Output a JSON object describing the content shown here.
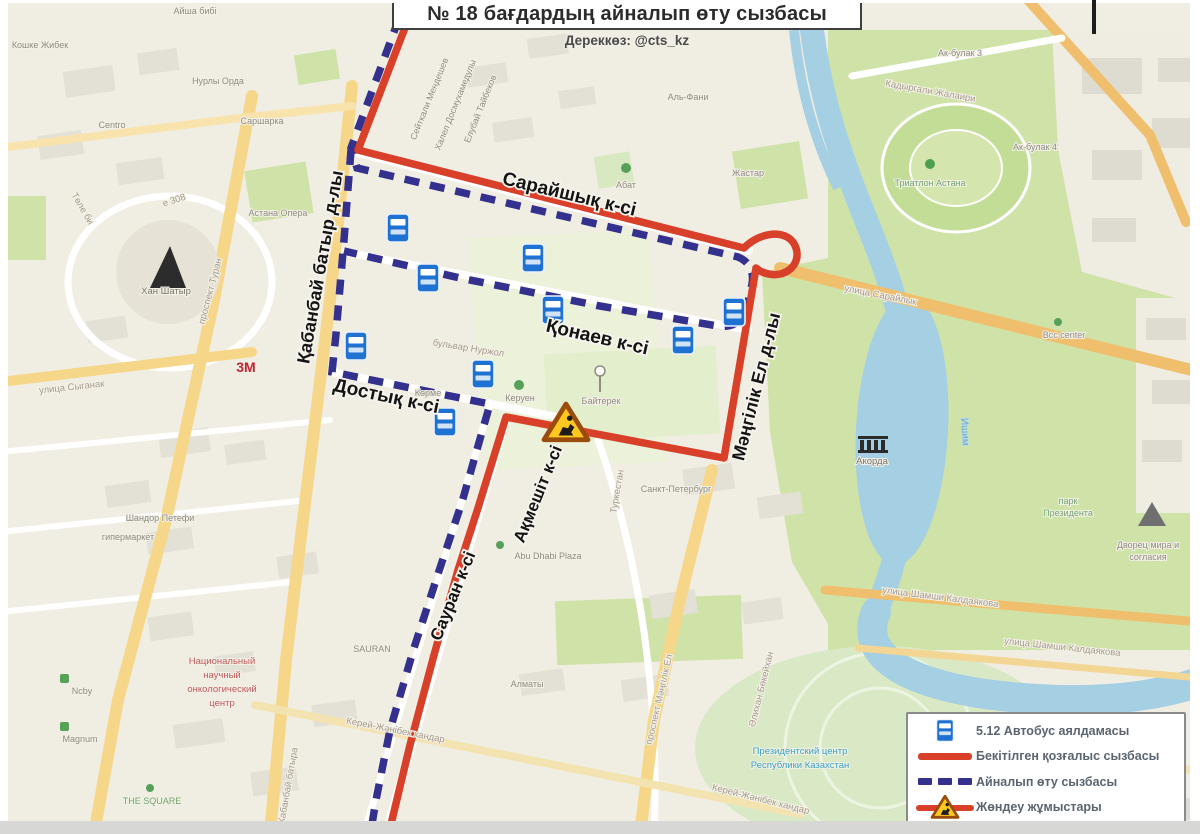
{
  "header": {
    "title": "№ 18 бағдардың айналып өту сызбасы",
    "source": "Дереккөз: @cts_kz"
  },
  "legend": {
    "items": [
      {
        "id": "bus-stop",
        "label": "5.12 Автобус аялдамасы"
      },
      {
        "id": "approved-route",
        "label": "Бекітілген қозғалыс сызбасы"
      },
      {
        "id": "detour-route",
        "label": "Айналып өту сызбасы"
      },
      {
        "id": "roadworks",
        "label": "Жөндеу жұмыстары"
      }
    ]
  },
  "colors": {
    "approved_route": "#d8402a",
    "detour_route": "#33308e",
    "bus_stop_sign": "#1f72d2",
    "warning_yellow": "#ffc81e",
    "water": "#a5cfe3",
    "park_green": "#cfe3a8"
  },
  "streets": {
    "saraishyq": "Сарайшық к-сі",
    "qonaev": "Қонаев к-сі",
    "dostyq": "Достық к-сі",
    "qabanbay": "Қабанбай батыр д-лы",
    "mangilik": "Мәңгілік Ел д-лы",
    "aqmeshit": "Ақмешіт к-сі",
    "sauran": "Сауран к-сі"
  },
  "labels": {
    "aisha_bibi": "Айша бибі",
    "koshke": "Кошке Жибек",
    "nurly_orda": "Нурлы Орда",
    "sarsharka": "Саршарка",
    "centro": "Centro",
    "astana_opera": "Астана Опера",
    "e308": "е 308",
    "tole_bi": "Төле би",
    "khan_shatyr": "Хан Шатыр",
    "prospekt_turan": "проспект Туран",
    "ulitsa_syganak": "улица Сыганак",
    "three_m": "3М",
    "shandor_petefi": "Шандор Петефи",
    "gipermarket": "гипермаркет",
    "onco1": "Национальный",
    "onco2": "научный",
    "onco3": "онкологический",
    "onco4": "центр",
    "ncby": "Ncby",
    "magnum": "Magnum",
    "the_square": "THE SQUARE",
    "kabanbay_batyra": "Кабанбай батыра",
    "sauran_bg": "SAURAN",
    "almaty": "Алматы",
    "kerey_zhanibek": "Керей-Жәнібек хандар",
    "prospekt_mangilik": "проспект Мәңгілік Ел",
    "bokeikhan": "Әлихан Бөкейхан",
    "prezident_center1": "Президентский центр",
    "prezident_center2": "Республики Казахстан",
    "shamshi": "улица Шамши Калдаякова",
    "ishim": "Ишим",
    "akorda": "Акорда",
    "park_prezidenta1": "парк",
    "park_prezidenta2": "Президента",
    "dvorets1": "Дворец мира и",
    "dvorets2": "согласия",
    "bcc": "Bcc center",
    "ulitsa_saraylyk": "улица Сарайлык",
    "kadyrgali": "Кадыргали Жалаири",
    "akbulak3": "Ак-булак 3",
    "akbulak4": "Ак-булак 4",
    "triatlon": "Триатлон Астана",
    "al_fani": "Аль-Фани",
    "abat": "Абат",
    "zhastar": "Жастар",
    "nurzhol": "бульвар Нуржол",
    "korme": "Көрме",
    "keruen": "Керуен",
    "baiterek": "Байтерек",
    "sankt_peterburg": "Санкт-Петербург",
    "turkestan": "Туркестан",
    "abu_dhabi": "Abu Dhabi Plaza",
    "mendeshev": "Сейткали Мендешев",
    "dosmukhameduly": "Халел Досмухамедулы",
    "taibekov": "Елубай Тайбеков"
  }
}
